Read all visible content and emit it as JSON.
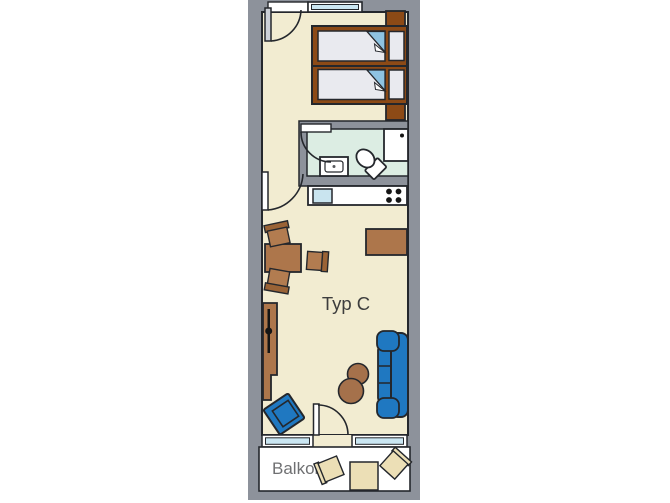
{
  "floor_plan": {
    "unit_label": "Typ C",
    "balcony_label": "Balkon",
    "rooms": [
      "bedroom",
      "bathroom",
      "kitchenette",
      "living-room",
      "hallway",
      "balcony"
    ],
    "furniture": [
      "twin-bed",
      "twin-bed",
      "nightstand",
      "nightstand",
      "shower",
      "toilet",
      "washbasin",
      "kitchen-counter",
      "kitchen-sink",
      "stove-burners",
      "dining-table",
      "chair",
      "chair",
      "chair",
      "sideboard",
      "wardrobe",
      "armchair",
      "sofa",
      "side-table",
      "side-table",
      "balcony-table",
      "balcony-chair",
      "balcony-chair"
    ],
    "openings": [
      "entrance-door",
      "hall-door",
      "bathroom-door",
      "balcony-door",
      "window-top",
      "window-bottom-left",
      "window-bottom-right"
    ],
    "colors": {
      "wall_gray": "#8d929b",
      "outline": "#24272c",
      "floor_cream": "#f2ecd1",
      "bathroom_mint": "#dcede3",
      "window_glass": "#cbe7f3",
      "bed_brown": "#8c4a16",
      "furniture_tan": "#ad764b",
      "furniture_blue": "#1f78c1",
      "blanket_fold_blue": "#8ec3e2",
      "kitchen_sink_blue": "#c9e4ef",
      "balcony_furniture_cream": "#ecdfb6",
      "unit_text": "#3d3d3d",
      "balcony_text": "#6f7072"
    }
  }
}
